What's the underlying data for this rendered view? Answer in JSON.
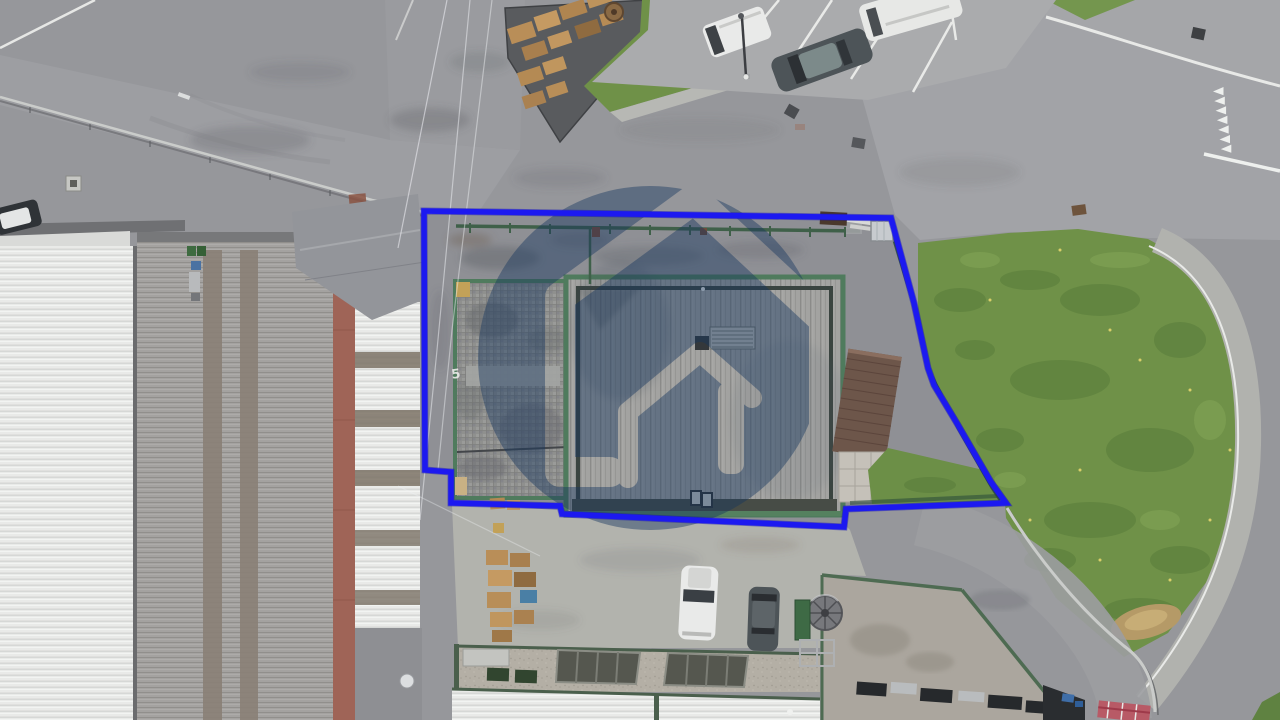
{
  "photo": {
    "kind": "aerial drone photo",
    "subject": "industrial property with warehouse, outlined plot boundary",
    "pavement_marking": "5"
  },
  "boundary": {
    "color": "#1c19f0",
    "stroke_width": "5.5"
  },
  "watermark": {
    "shape": "house logo in translucent circle",
    "color": "#16365f",
    "opacity": "0.43"
  },
  "colors": {
    "asphalt": "#96979b",
    "road_light": "#9d9ea2",
    "concrete_yard": "#b2b3ad",
    "property_yard": "#8f9095",
    "grass": "#6f9148",
    "grass_dark": "#567a39",
    "roof_white": "#e9eae8",
    "roof_gray": "#a3a3a1",
    "roof_stripe": "#8a8076",
    "terracotta": "#9f6457",
    "cobble": "#8f908e",
    "lean_to_brown": "#6d564a",
    "green_trim": "#4f7b5d",
    "fence_green": "#2e4f3a",
    "guardrail": "#caccca",
    "white_marking": "#eef0ee",
    "sand": "#b59a67",
    "van_white": "#e9eae9",
    "car_dark": "#4d5458",
    "pallet_wood": "#b98e58",
    "skylight_dark": "#55574f",
    "barrier_red": "#b85a66",
    "flat_roof_tan": "#b4afa5"
  }
}
